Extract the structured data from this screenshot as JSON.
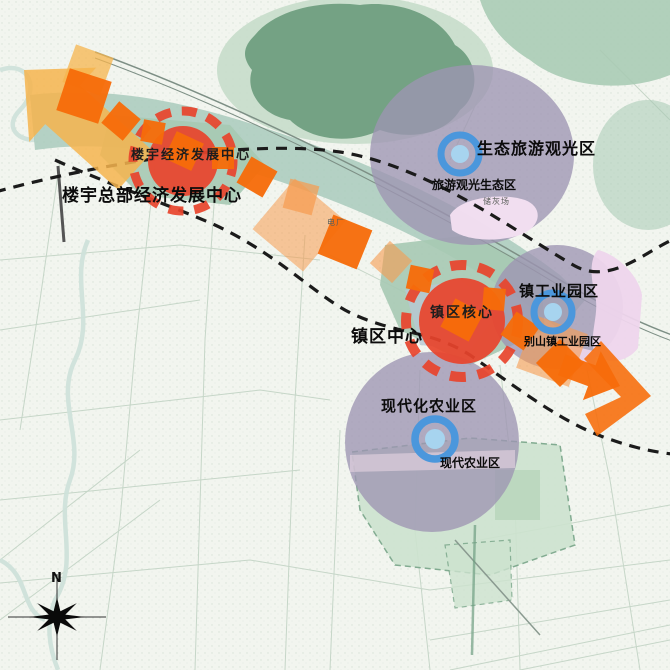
{
  "zones": [
    {
      "id": "hq",
      "name": "楼宇总部经济发展中心",
      "core_label": "楼宇经济发展中心",
      "marker": "red-dashed-circle"
    },
    {
      "id": "eco-tourism",
      "name": "生态旅游观光区",
      "sub_label": "旅游观光生态区",
      "marker": "blue-ring"
    },
    {
      "id": "industrial",
      "name": "镇工业园区",
      "sub_label": "别山镇工业园区",
      "marker": "blue-ring"
    },
    {
      "id": "town-center",
      "name": "镇区中心",
      "core_label": "镇区核心",
      "marker": "red-dashed-circle"
    },
    {
      "id": "agriculture",
      "name": "现代化农业区",
      "sub_label": "现代农业区",
      "marker": "blue-ring"
    }
  ],
  "map_annotations": {
    "power_plant": "电厂",
    "ash_yard": "储灰场"
  },
  "compass": {
    "north_label": "N"
  },
  "colors": {
    "map_bg": "#f2f5ef",
    "road": "#c6d6c8",
    "road_dark": "#7d8f85",
    "river": "#cfe2da",
    "forest_dark": "#74a284",
    "forest_light": "#c6ddca",
    "green_mid": "#a6c9b2",
    "corridor": "#a9cabc",
    "bluegray": "#b6c8d3",
    "zone_purple": "#9d95b2",
    "zone_pink": "#eed5ec",
    "field_green": "#cde3cf",
    "axis_orange": "#f76c09",
    "axis_light": "#f79b4e",
    "golden": "#f6b44e",
    "center_red": "#e8432b",
    "ring_blue": "#4b97dc",
    "ring_blue_inner": "#a7d4ef",
    "dash_black": "#1b1b1b",
    "label": "#0b0b0b"
  }
}
